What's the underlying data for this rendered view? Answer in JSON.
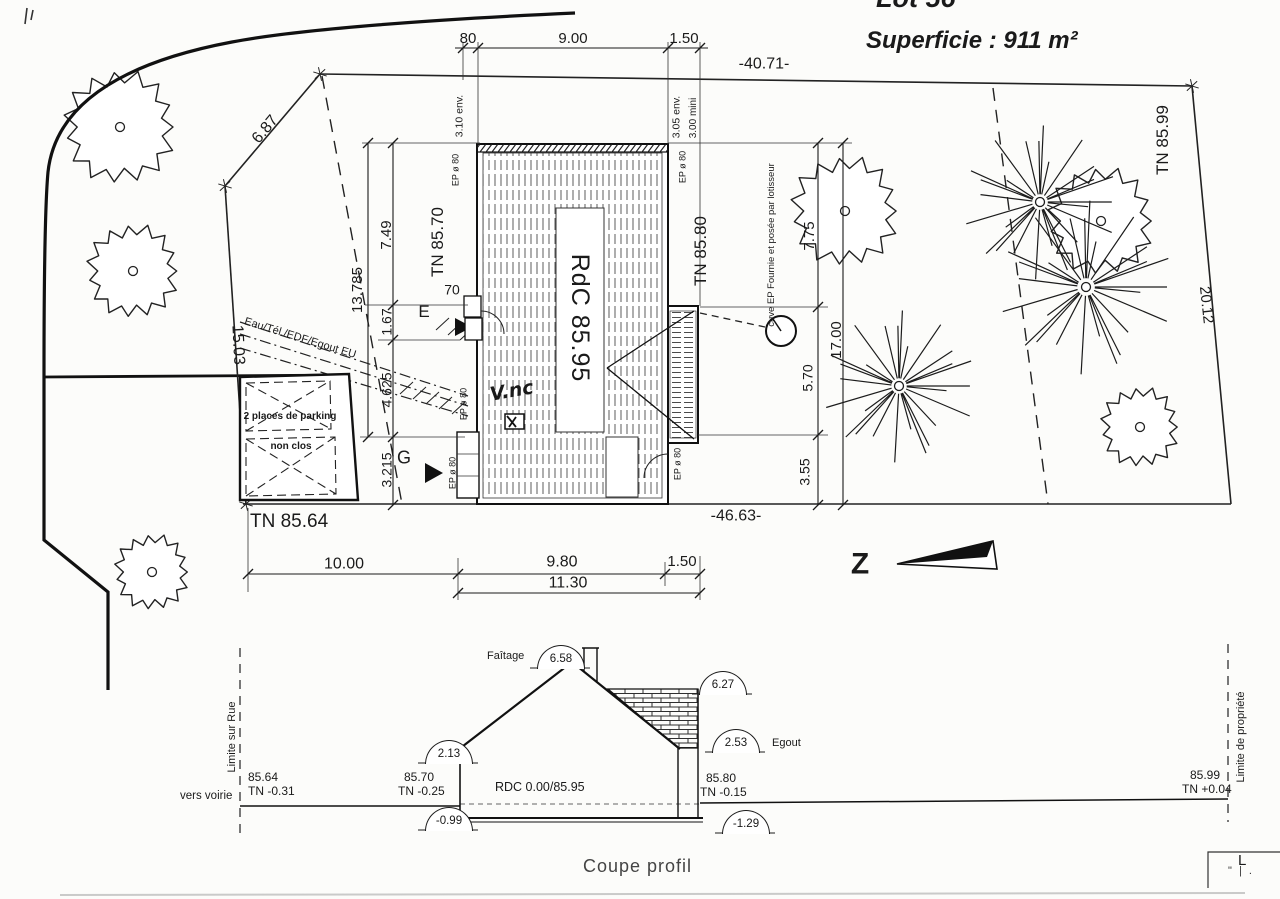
{
  "header": {
    "lot": "Lot 56",
    "superficie": "Superficie : 911 m²"
  },
  "plan": {
    "top_dims": {
      "a": "80",
      "b": "9.00",
      "c": "1.50",
      "total": "-40.71-"
    },
    "left_dims": {
      "upper": "6.87",
      "side": "15.03",
      "total": "13.785",
      "a": "7.49",
      "b": "1.67",
      "c": "4.625",
      "d": "3.215"
    },
    "right_dims": {
      "a": "7.75",
      "b": "5.70",
      "c": "3.55",
      "total": "17.00",
      "side": "20.12"
    },
    "bottom_dims": {
      "a": "10.00",
      "b": "9.80",
      "c": "1.50",
      "total": "11.30",
      "boundary": "-46.63-"
    },
    "house": {
      "rdc": "RdC 85.95",
      "depth_left": "3.10 env.",
      "depth_right": "3.05 env.",
      "depth_min": "3.00 mini",
      "ep": "EP ø 80",
      "entry": "E",
      "g": "G",
      "n70": "70",
      "handwritten": "V.nc"
    },
    "levels": {
      "tn_64": "TN 85.64",
      "tn_70": "TN 85.70",
      "tn_80": "TN 85.80",
      "tn_99": "TN 85.99"
    },
    "annotations": {
      "utilities": "Eau/Tél./EDF/Egout EU",
      "parking1": "2 places de parking",
      "parking2": "non clos",
      "cuve": "cuve EP Fournie et posée par lotisseur",
      "north": "Z"
    }
  },
  "profile": {
    "title": "Coupe profil",
    "faitage_label": "Faîtage",
    "egout_label": "Egout",
    "bubbles": {
      "faitage": "6.58",
      "gable": "6.27",
      "egout": "2.53",
      "eave_left": "2.13",
      "base_left": "-0.99",
      "base_right": "-1.29"
    },
    "levels": {
      "a1": "85.64",
      "a2": "TN -0.31",
      "b1": "85.70",
      "b2": "TN -0.25",
      "rdc": "RDC 0.00/85.95",
      "c1": "85.80",
      "c2": "TN -0.15",
      "d1": "85.99",
      "d2": "TN +0.04"
    },
    "limits": {
      "street": "Limite sur Rue",
      "property": "Limite de propriété",
      "voirie": "vers voirie"
    }
  },
  "corner": {
    "l": "L",
    "marks": "\" | ."
  }
}
